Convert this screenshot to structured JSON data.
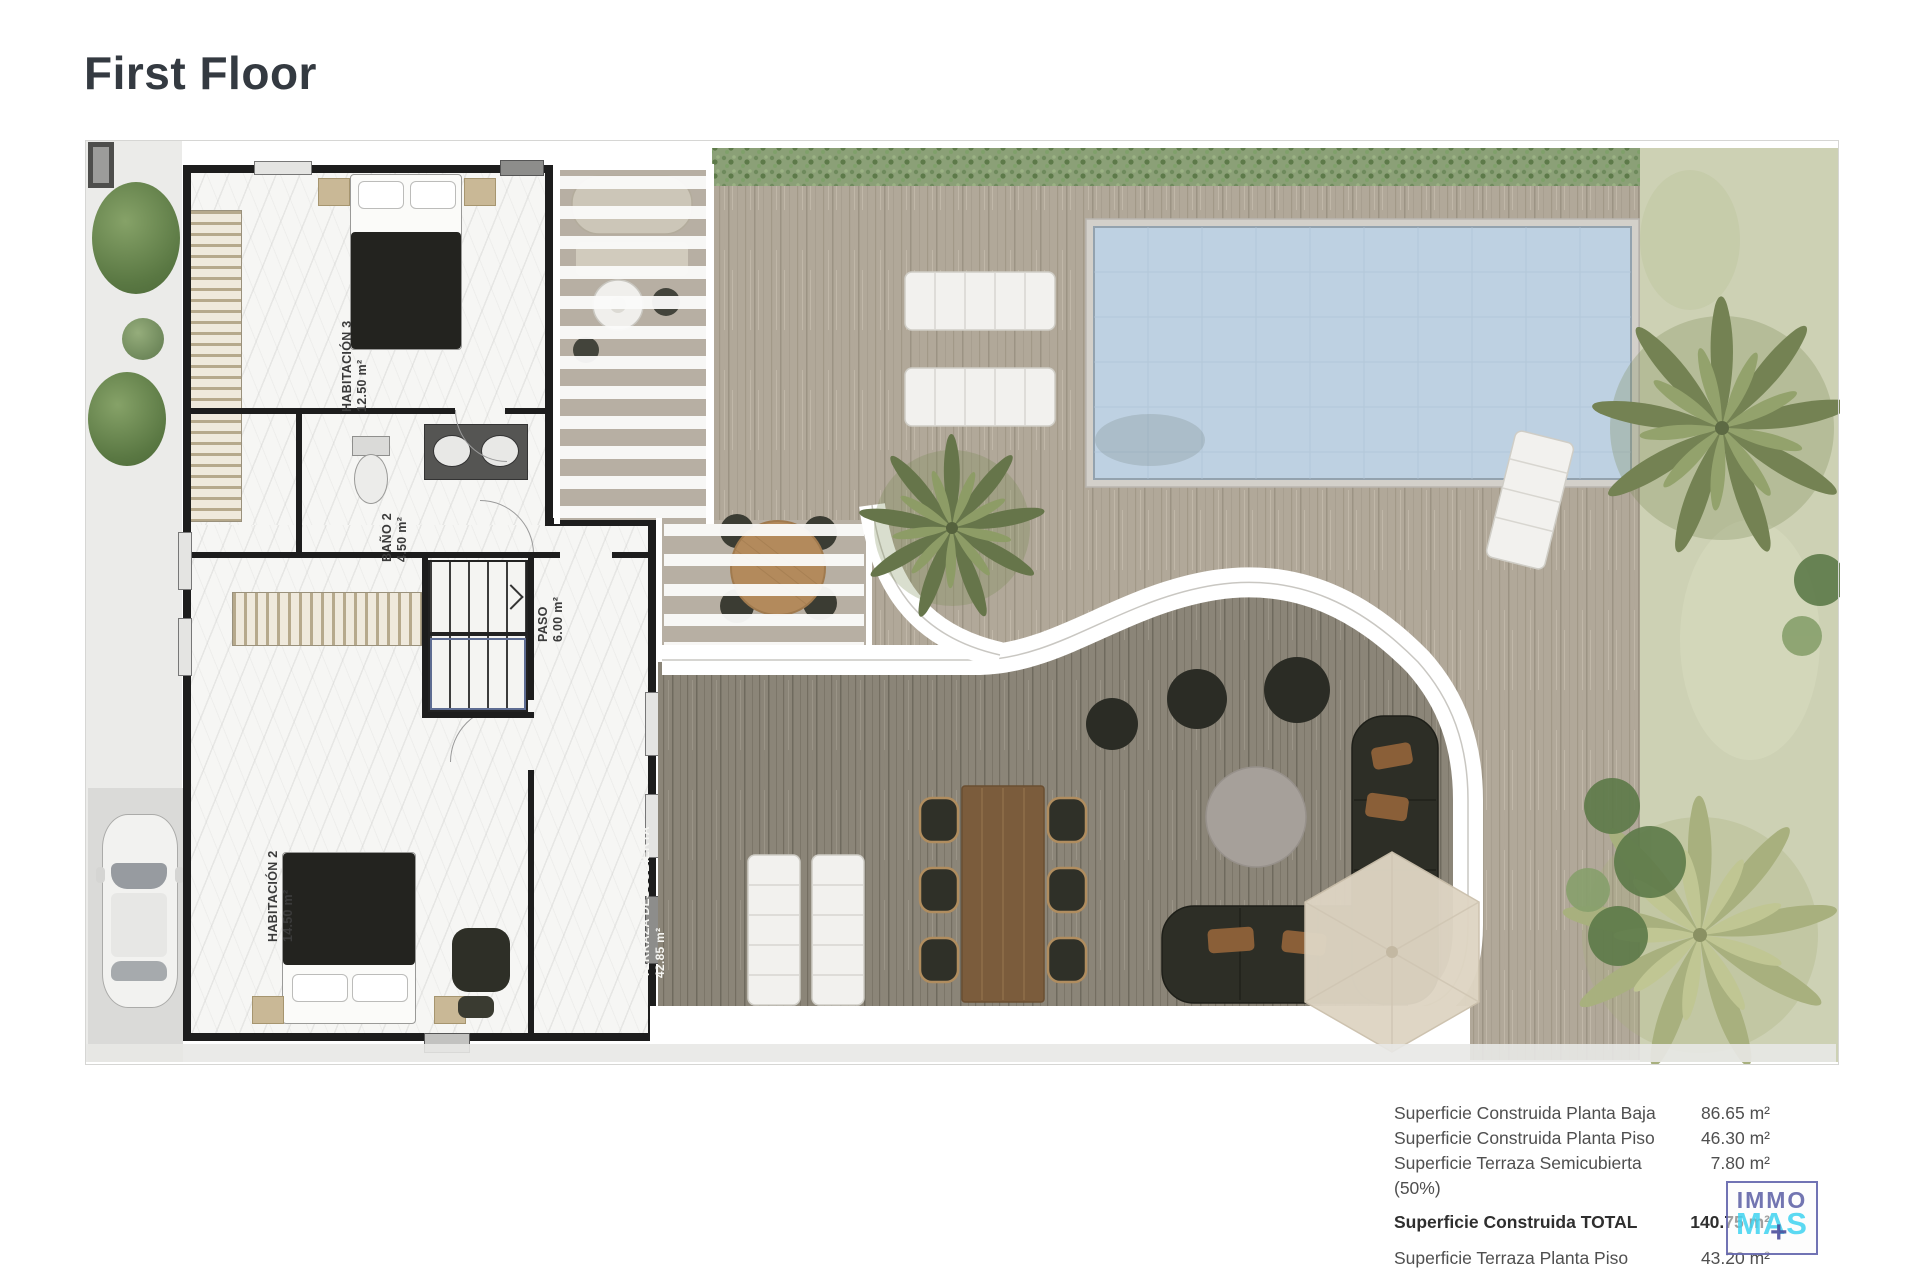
{
  "page": {
    "title": "First Floor"
  },
  "rooms": [
    {
      "name": "HABITACIÓN 3",
      "area": "12.50 m²"
    },
    {
      "name": "BAÑO 2",
      "area": "4.50 m²"
    },
    {
      "name": "PASO",
      "area": "6.00 m²"
    },
    {
      "name": "HABITACIÓN 2",
      "area": "14.50 m²"
    },
    {
      "name": "TERRAZA DESCUBIERTA",
      "area": "42.85 m²"
    }
  ],
  "summary": {
    "rows": [
      {
        "label": "Superficie Construida Planta Baja",
        "value": "86.65 m²"
      },
      {
        "label": "Superficie Construida Planta Piso",
        "value": "46.30 m²"
      },
      {
        "label": "Superficie Terraza Semicubierta (50%)",
        "value": "7.80 m²"
      },
      {
        "label": "Superficie Construida TOTAL",
        "value": "140.75 m²"
      },
      {
        "label": "Superficie Terraza Planta Piso",
        "value": "43.20 m²"
      }
    ]
  },
  "logo": {
    "line1": "IMMO",
    "line2": "MAS",
    "plus": "+"
  },
  "colors": {
    "logo_purple": "#5a5da9",
    "logo_cyan": "#3ed2f0",
    "pool_water": "#bed1e2",
    "deck_light": "#b1a899",
    "deck_dark": "#8b8578",
    "hedge_green": "#8ba077",
    "grass_green": "#cdd1b4",
    "wall_black": "#1d1d1d"
  }
}
